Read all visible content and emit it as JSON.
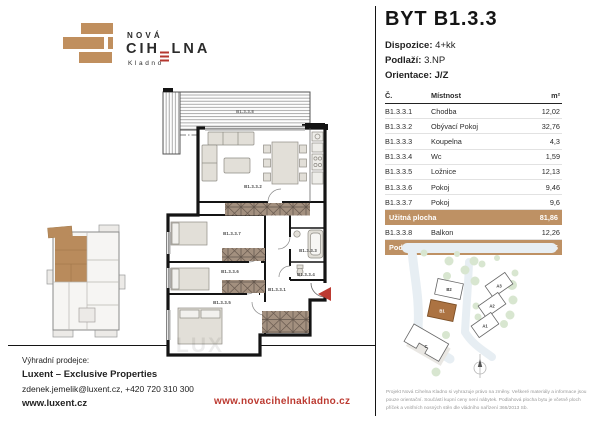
{
  "theme": {
    "brick": "#C08F5E",
    "highlight": "#BE9164",
    "accent_red": "#B5372F",
    "url_red": "#BC3A31",
    "wall": "#141414",
    "unit_brown": "#B98B5C",
    "tree_green": "#D8E6D0",
    "road_blue": "#E7EEF3"
  },
  "brand": {
    "line1": "NOVÁ",
    "line2_pre": "CIH",
    "line2_post": "LNA",
    "line3": "Kladno"
  },
  "header": {
    "title": "BYT B1.3.3",
    "fields": [
      {
        "label": "Dispozice:",
        "value": "4+kk"
      },
      {
        "label": "Podlaží:",
        "value": "3.NP"
      },
      {
        "label": "Orientace:",
        "value": "J/Z"
      }
    ]
  },
  "room_table": {
    "col_no": "Č.",
    "col_room": "Místnost",
    "col_area": "m²",
    "rows": [
      {
        "no": "B1.3.3.1",
        "room": "Chodba",
        "area": "12,02"
      },
      {
        "no": "B1.3.3.2",
        "room": "Obývací Pokoj",
        "area": "32,76"
      },
      {
        "no": "B1.3.3.3",
        "room": "Koupelna",
        "area": "4,3"
      },
      {
        "no": "B1.3.3.4",
        "room": "Wc",
        "area": "1,59"
      },
      {
        "no": "B1.3.3.5",
        "room": "Ložnice",
        "area": "12,13"
      },
      {
        "no": "B1.3.3.6",
        "room": "Pokoj",
        "area": "9,46"
      },
      {
        "no": "B1.3.3.7",
        "room": "Pokoj",
        "area": "9,6"
      }
    ],
    "usable": {
      "label": "Užitná plocha",
      "value": "81,86"
    },
    "balcony": {
      "no": "B1.3.3.8",
      "room": "Balkon",
      "area": "12,26"
    },
    "floor": {
      "label": "Podlahová plocha",
      "value": "85,75"
    }
  },
  "floorplan": {
    "labels": {
      "balcony": "B1.3.3.8",
      "living": "B1.3.3.2",
      "room7": "B1.3.3.7",
      "room6": "B1.3.3.6",
      "bedroom": "B1.3.3.5",
      "bath": "B1.3.3.3",
      "wc": "B1.3.3.4",
      "hall": "B1.3.3.1"
    }
  },
  "siteplan": {
    "labels": {
      "b2": "B2",
      "b1": "B1",
      "a3": "A3",
      "a2": "A2",
      "a1": "A1",
      "c": "C"
    }
  },
  "contact": {
    "heading": "Výhradní prodejce:",
    "company": "Luxent – Exclusive Properties",
    "email_phone": "zdenek.jemelik@luxent.cz, +420 720 310 300",
    "web": "www.luxent.cz"
  },
  "footer": {
    "project_web": "www.novacihelnakladno.cz",
    "disclaimer": "Projekt Nová Cihelna Kladno si vyhrazuje právo na změny. Veškeré materiály a informace jsou pouze orientační. Součástí kupní ceny není nábytek. Podlahová plocha bytu je včetně ploch příček a vnitřních nosných stěn dle vládního nařízení 366/2013 Sb."
  },
  "watermark": "LUX"
}
